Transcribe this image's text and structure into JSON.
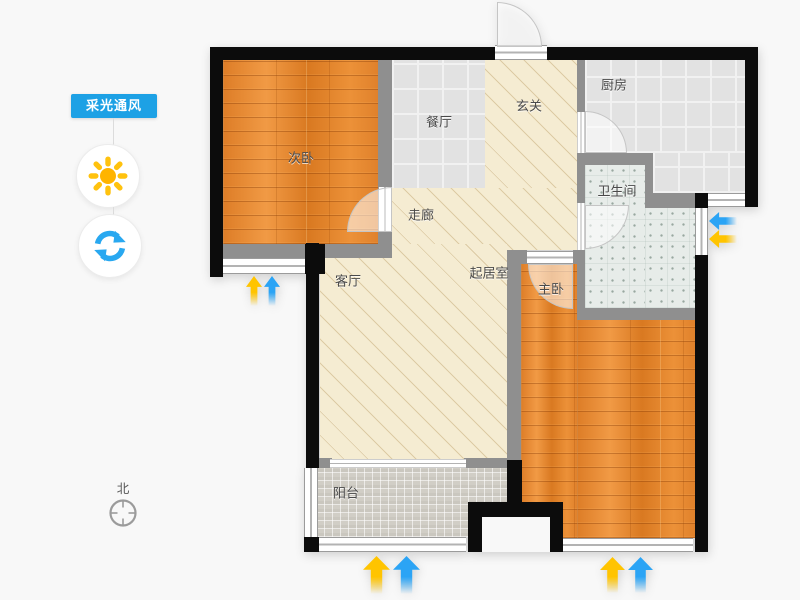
{
  "panel": {
    "badge_label": "采光通风",
    "badge_color": "#1da1e5",
    "sun_button": {
      "icon": "sun-icon",
      "color": "#ffc20e"
    },
    "refresh_button": {
      "icon": "refresh-icon",
      "color": "#29a8f0"
    }
  },
  "compass": {
    "label": "北"
  },
  "floorplan": {
    "rooms": {
      "secondary_bedroom": {
        "label": "次卧",
        "floor": "wood"
      },
      "dining": {
        "label": "餐厅",
        "floor": "tile"
      },
      "hall": {
        "label": "玄关",
        "floor": "screed"
      },
      "kitchen": {
        "label": "厨房",
        "floor": "tile"
      },
      "bathroom": {
        "label": "卫生间",
        "floor": "mosaic-plus"
      },
      "corridor": {
        "label": "走廊",
        "floor": "screed"
      },
      "living": {
        "label": "客厅",
        "floor": "screed"
      },
      "sitting": {
        "label": "起居室",
        "floor": "screed"
      },
      "master_bedroom": {
        "label": "主卧",
        "floor": "wood"
      },
      "balcony": {
        "label": "阳台",
        "floor": "mosaic"
      }
    },
    "legend": {
      "lighting_arrow_color": "#ffc400",
      "airflow_arrow_color": "#2ba4f5",
      "wall_exterior_color": "#0c0c0c",
      "wall_interior_color": "#8f8f8f"
    }
  }
}
